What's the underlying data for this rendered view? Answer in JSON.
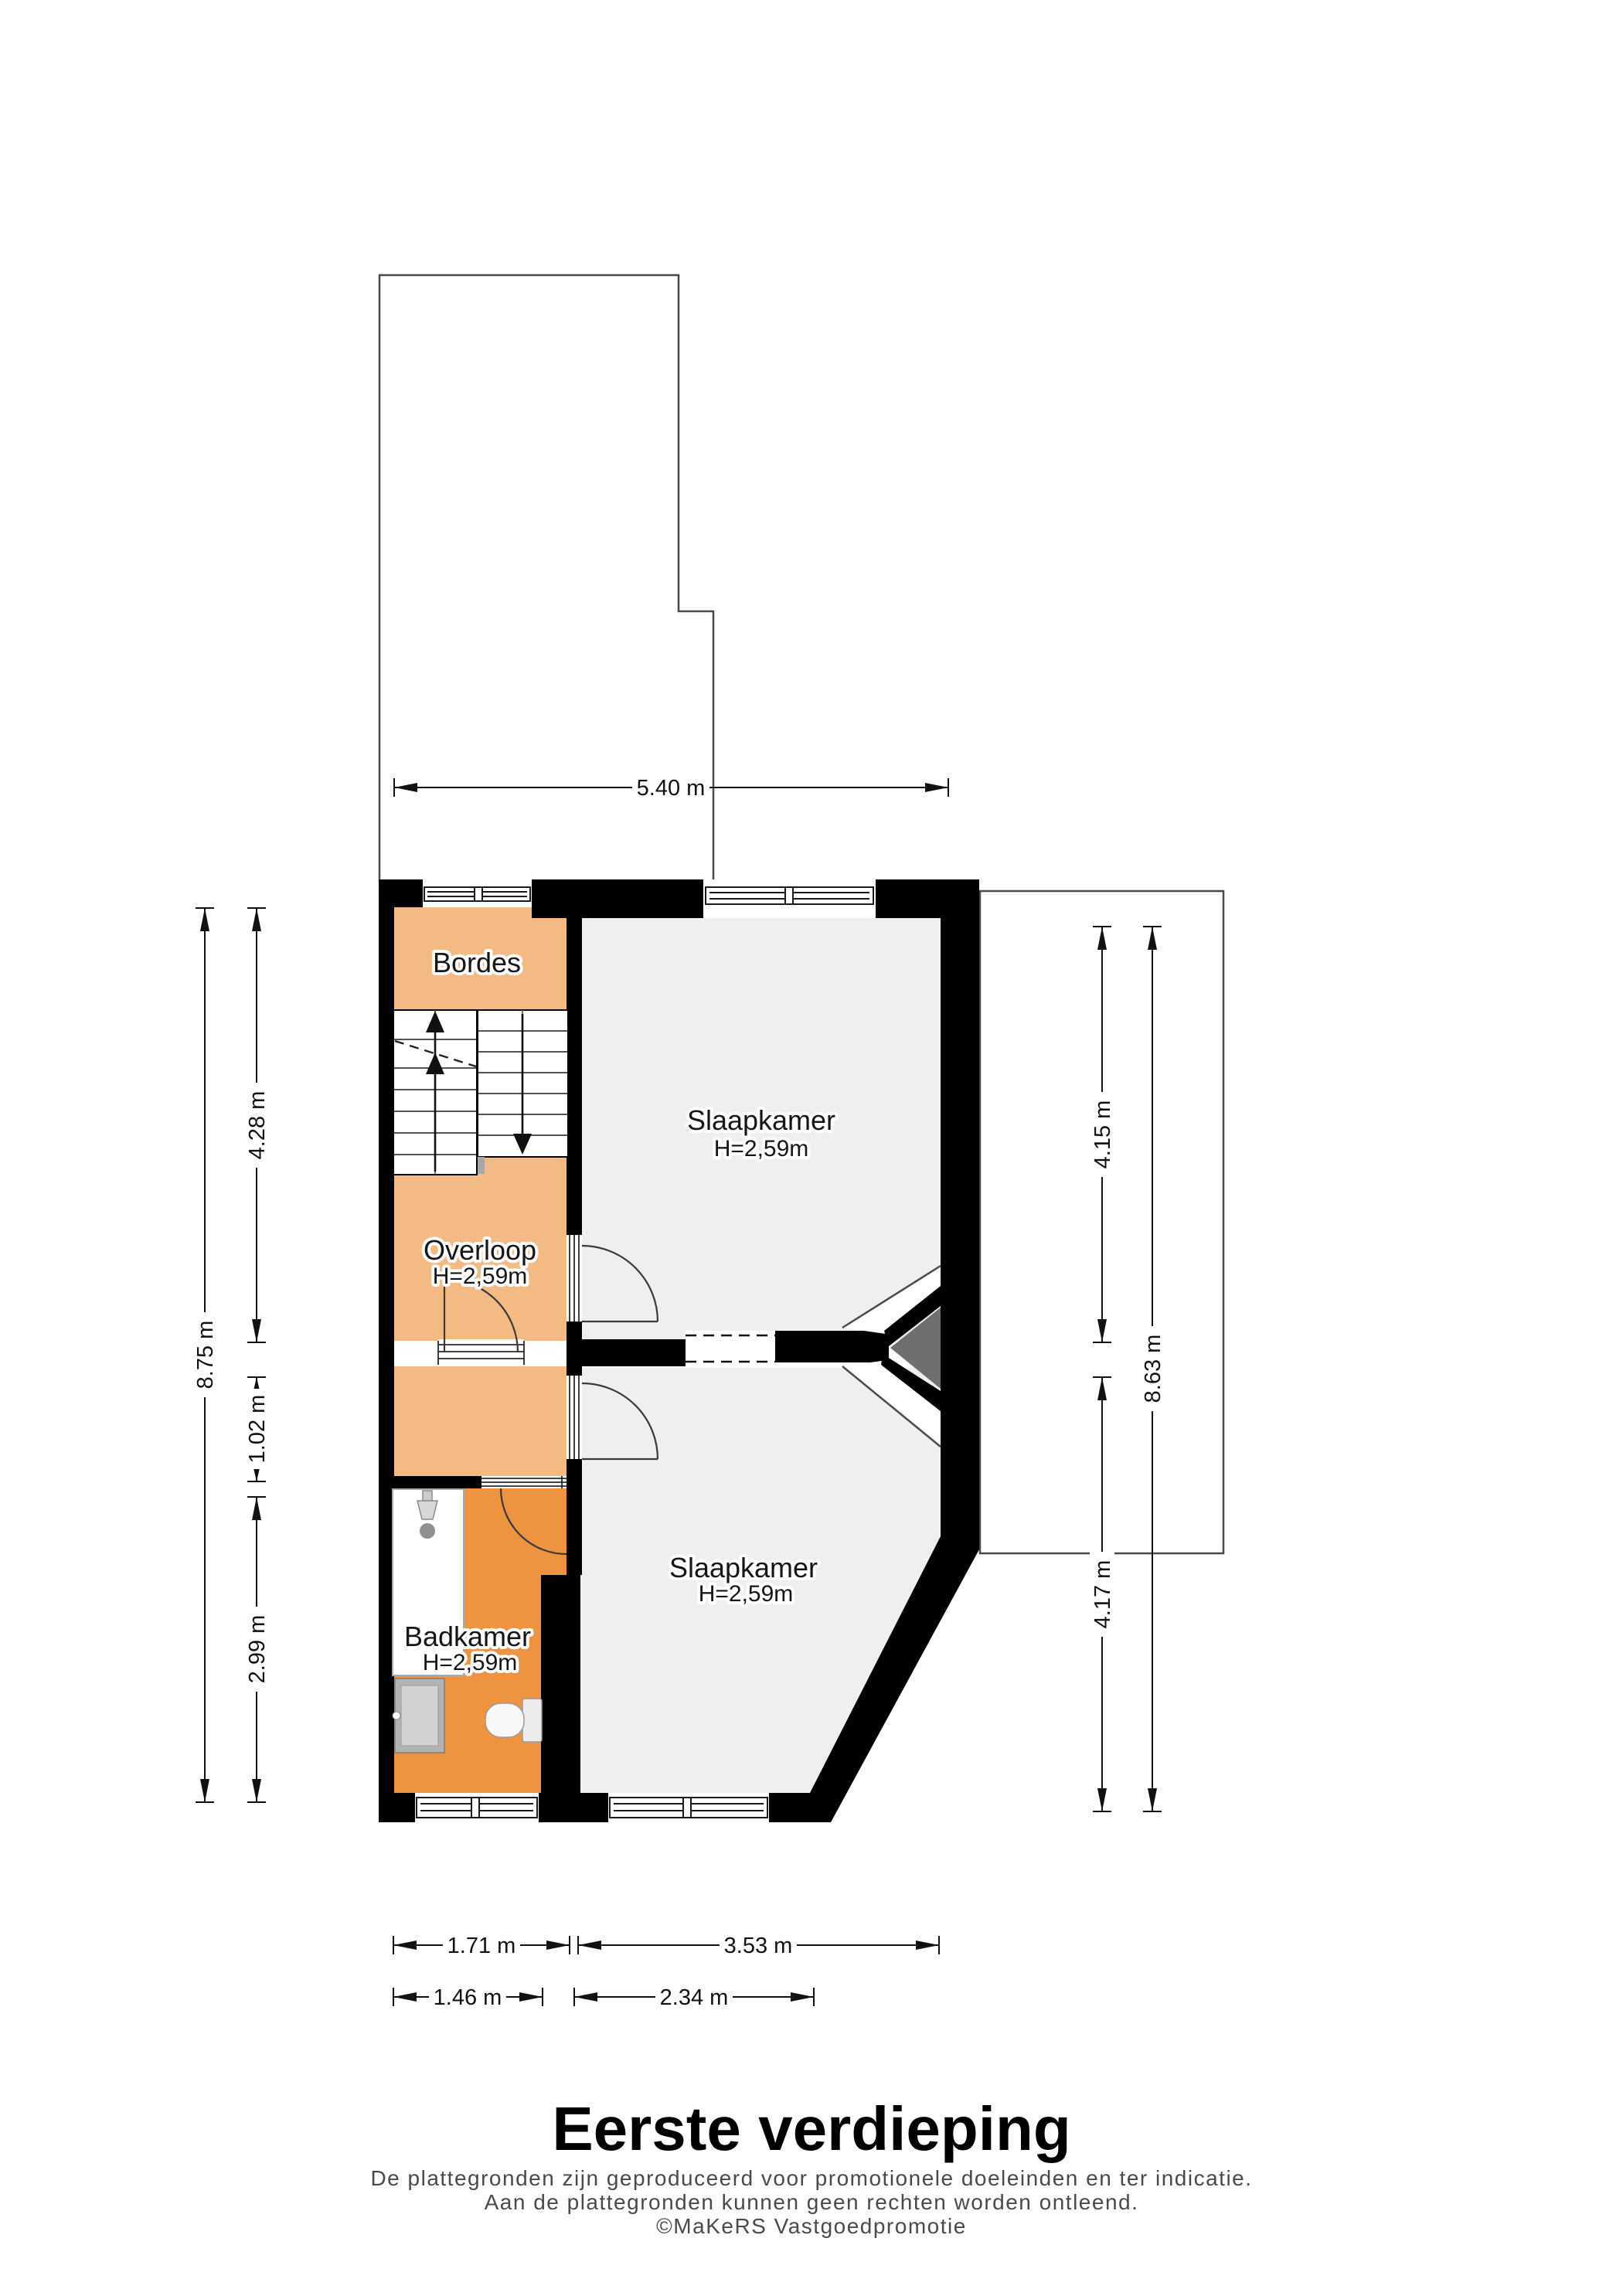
{
  "title": "Eerste verdieping",
  "footer": {
    "line1": "De plattegronden zijn geproduceerd voor promotionele doeleinden en ter indicatie.",
    "line2": "Aan de plattegronden kunnen geen rechten worden ontleend.",
    "line3": "©MaKeRS Vastgoedpromotie"
  },
  "rooms": {
    "bordes": {
      "name": "Bordes"
    },
    "slaapkamer_voor": {
      "name": "Slaapkamer",
      "height": "H=2,59m"
    },
    "overloop": {
      "name": "Overloop",
      "height": "H=2,59m"
    },
    "badkamer": {
      "name": "Badkamer",
      "height": "H=2,59m"
    },
    "slaapkamer_achter": {
      "name": "Slaapkamer",
      "height": "H=2,59m"
    }
  },
  "dimensions": {
    "top": "5.40 m",
    "left_outer": "8.75 m",
    "left_segments": [
      "4.28 m",
      "1.02 m",
      "2.99 m"
    ],
    "right_segments": [
      "4.15 m",
      "4.17 m"
    ],
    "right_outer": "8.63 m",
    "bottom_row1": [
      "1.71 m",
      "3.53 m"
    ],
    "bottom_row2": [
      "1.46 m",
      "2.34 m"
    ]
  },
  "colors": {
    "wall": "#000000",
    "room_floor_gray": "#EFEFEF",
    "hall_orange": "#F3BA83",
    "bathroom_orange": "#EE9440",
    "chimney_gray": "#6F6F6F",
    "outline_gray": "#4A4A4A",
    "footer_text": "#4A4A4A"
  }
}
